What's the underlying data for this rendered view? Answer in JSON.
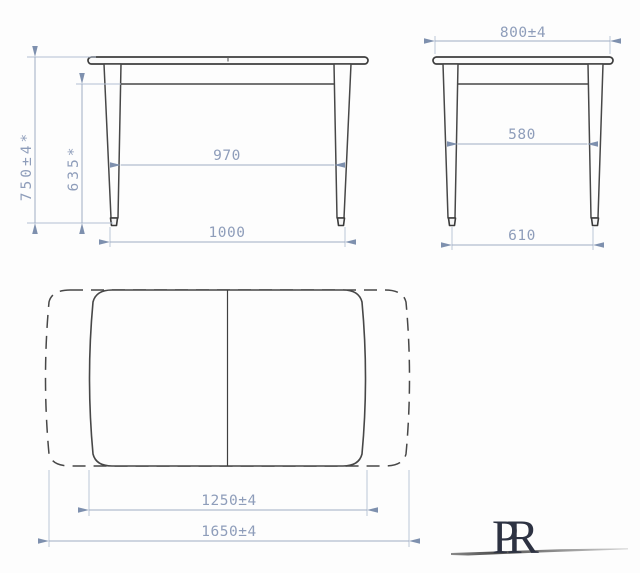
{
  "views": {
    "front": {
      "dim_height": "750±4*",
      "dim_apron_clearance": "635*",
      "dim_inner_span": "970",
      "dim_outer_span": "1000"
    },
    "side": {
      "dim_width": "800±4",
      "dim_inner_span": "580",
      "dim_outer_span": "610"
    },
    "top": {
      "dim_length_closed": "1250±4",
      "dim_length_extended": "1650±4"
    },
    "logo": {
      "text": "PR"
    },
    "colors": {
      "outline": "#474747",
      "dimension_line": "#9fadc4",
      "dimension_text": "#8e9dba",
      "logo_text": "#2d3242",
      "background": "#fdfdfd"
    }
  }
}
